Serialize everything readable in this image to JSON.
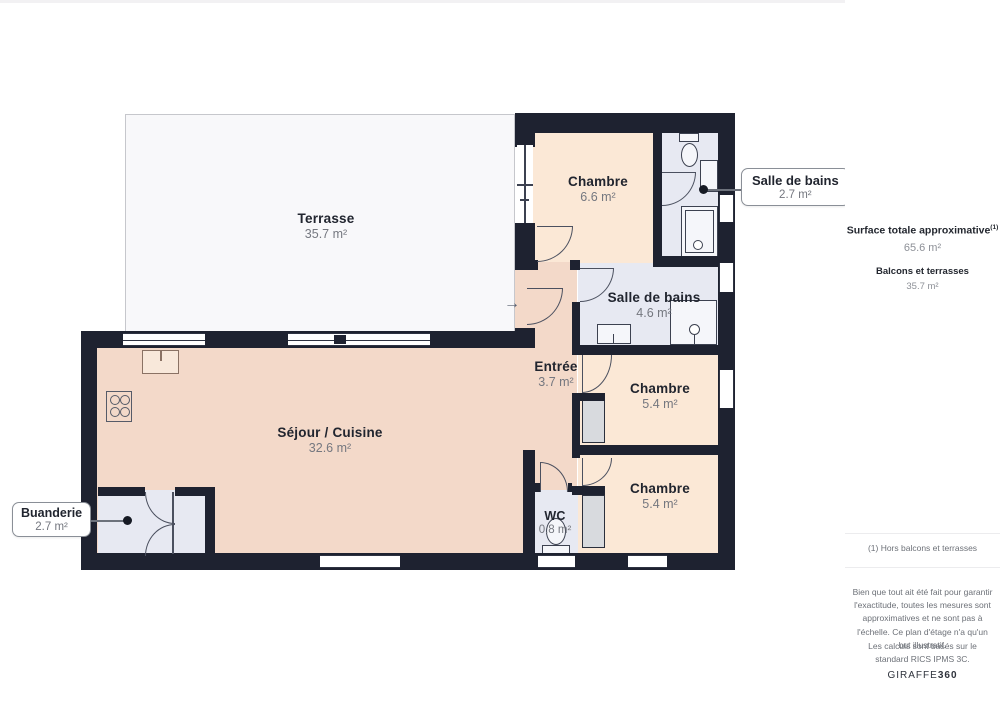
{
  "plan": {
    "rooms": {
      "terrasse": {
        "name": "Terrasse",
        "area": "35.7 m²"
      },
      "chambre1": {
        "name": "Chambre",
        "area": "6.6 m²"
      },
      "sdb_top": {
        "name": "Salle de bains",
        "area": "2.7 m²"
      },
      "sdb_mid": {
        "name": "Salle de bains",
        "area": "4.6 m²"
      },
      "entree": {
        "name": "Entrée",
        "area": "3.7 m²"
      },
      "chambre2": {
        "name": "Chambre",
        "area": "5.4 m²"
      },
      "chambre3": {
        "name": "Chambre",
        "area": "5.4 m²"
      },
      "sejour": {
        "name": "Séjour / Cuisine",
        "area": "32.6 m²"
      },
      "wc": {
        "name": "WC",
        "area": "0.8 m²"
      },
      "buanderie": {
        "name": "Buanderie",
        "area": "2.7 m²"
      }
    },
    "entrance_arrow": "→"
  },
  "sidebar": {
    "total_label": "Surface totale approximative",
    "total_superscript": "(1)",
    "total_value": "65.6 m²",
    "balconies_label": "Balcons et terrasses",
    "balconies_value": "35.7 m²",
    "footnote": "(1) Hors balcons et terrasses",
    "disclaimer": "Bien que tout ait été fait pour garantir l'exactitude, toutes les mesures sont approximatives et ne sont pas à l'échelle. Ce plan d'étage n'a qu'un but illustratif.",
    "standard_note": "Les calculs sont basés sur le standard RICS IPMS 3C.",
    "brand_name": "GIRAFFE",
    "brand_suffix": "360"
  },
  "colors": {
    "wall": "#1e2230",
    "room_living": "#f3d9c9",
    "room_bedroom": "#fbe8d6",
    "room_wet": "#e7e9f2",
    "terrace": "#f8f8fa"
  }
}
